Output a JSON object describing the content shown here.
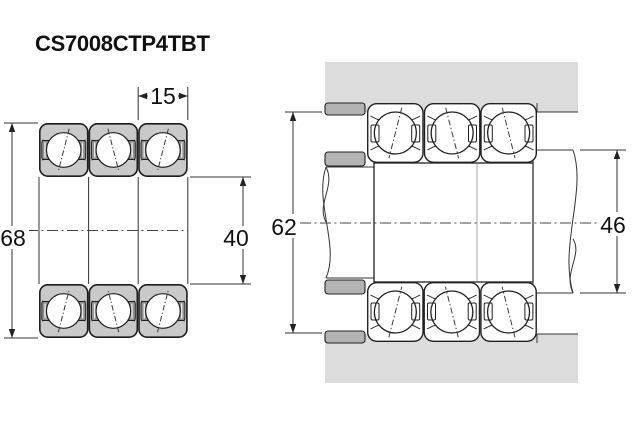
{
  "part_number": "CS7008CTP4TBT",
  "views": {
    "left": "bearing-set-cross-section",
    "right": "mounted-arrangement-section"
  },
  "dimensions": {
    "outer_diameter": "68",
    "bore_diameter": "40",
    "bearing_width": "15",
    "housing_shoulder_diameter": "62",
    "shaft_shoulder_diameter": "46"
  },
  "colors": {
    "background": "#ffffff",
    "bearing_ring_fill": "#c9c9c9",
    "cage_fill": "#929292",
    "housing_fill": "#dcdcdc",
    "spacer_fill": "#b3b3b3",
    "outline": "#1d1d1d"
  }
}
